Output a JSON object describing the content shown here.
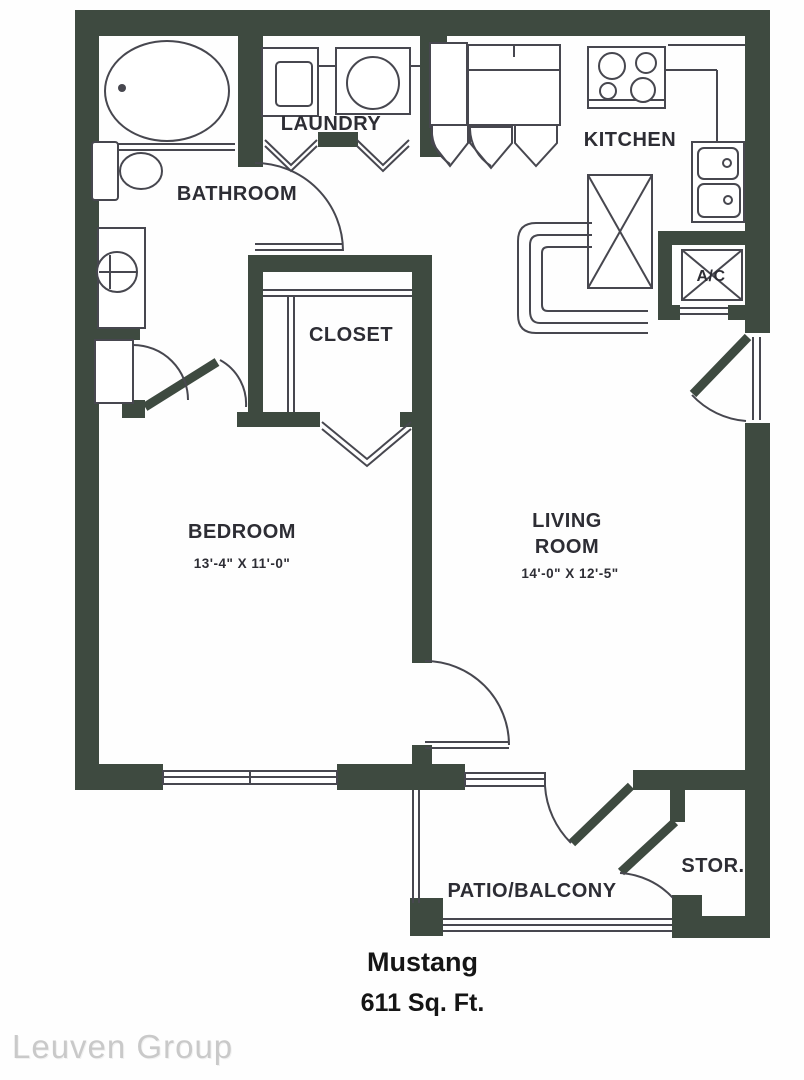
{
  "floorplan": {
    "rooms": {
      "bathroom": {
        "label": "BATHROOM"
      },
      "laundry": {
        "label": "LAUNDRY"
      },
      "kitchen": {
        "label": "KITCHEN"
      },
      "closet": {
        "label": "CLOSET"
      },
      "bedroom": {
        "label": "BEDROOM",
        "dimensions": "13'-4\" X 11'-0\""
      },
      "living_room": {
        "label_line1": "LIVING",
        "label_line2": "ROOM",
        "dimensions": "14'-0\" X 12'-5\""
      },
      "ac_closet": {
        "label": "A/C"
      },
      "storage": {
        "label": "STOR."
      },
      "patio": {
        "label": "PATIO/BALCONY"
      }
    },
    "colors": {
      "wall": "#3e4a40",
      "line": "#47474f",
      "label_text": "#2d2d34"
    }
  },
  "footer": {
    "plan_name": "Mustang",
    "area": "611 Sq. Ft."
  },
  "watermark": "Leuven Group"
}
